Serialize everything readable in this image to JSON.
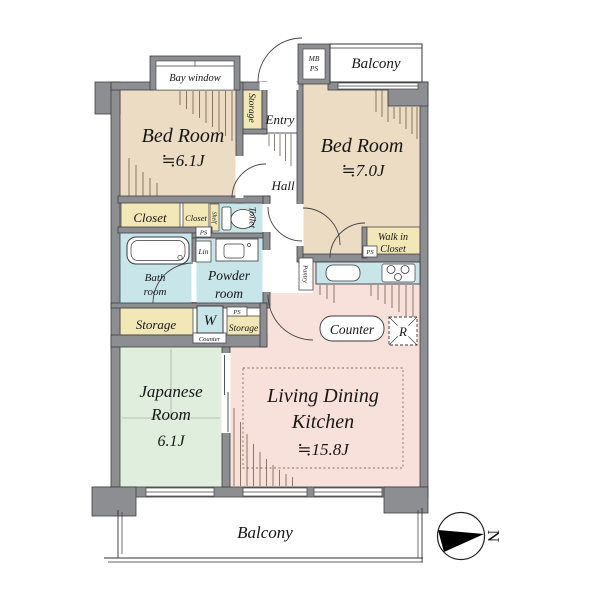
{
  "plan": {
    "bedroom1": {
      "name": "Bed Room",
      "area": "≒6.1J"
    },
    "bedroom2": {
      "name": "Bed Room",
      "area": "≒7.0J"
    },
    "japanese_room": {
      "name1": "Japanese",
      "name2": "Room",
      "area": "6.1J"
    },
    "ldk": {
      "name1": "Living Dining",
      "name2": "Kitchen",
      "area": "≒15.8J"
    },
    "bath": {
      "line1": "Bath",
      "line2": "room"
    },
    "powder": {
      "line1": "Powder",
      "line2": "room"
    },
    "walk_in_closet": {
      "line1": "Walk in",
      "line2": "Closet"
    },
    "entry": "Entry",
    "hall": "Hall",
    "balcony_top": "Balcony",
    "balcony_bottom": "Balcony",
    "bay_window": "Bay window",
    "storage_hall": "Storage",
    "storage_left": "Storage",
    "storage_mid": "Storage",
    "closet_large": "Closet",
    "closet_small": "Closet",
    "shelf": "Shelf",
    "toilet": "Toilet",
    "pantry": "Pantry",
    "mb": "MB",
    "ps": "PS",
    "lin": "Lin",
    "washer": "W",
    "counter_kitchen": "Counter",
    "counter_small": "Counter",
    "refrigerator": "R",
    "north": "N"
  },
  "colors": {
    "wall": "#8d8e92",
    "tan": "#ecdcc3",
    "yellow": "#f2e7b6",
    "blue": "#c8e5ea",
    "green": "#e0eedd",
    "pink": "#f8e1da",
    "white": "#ffffff"
  }
}
